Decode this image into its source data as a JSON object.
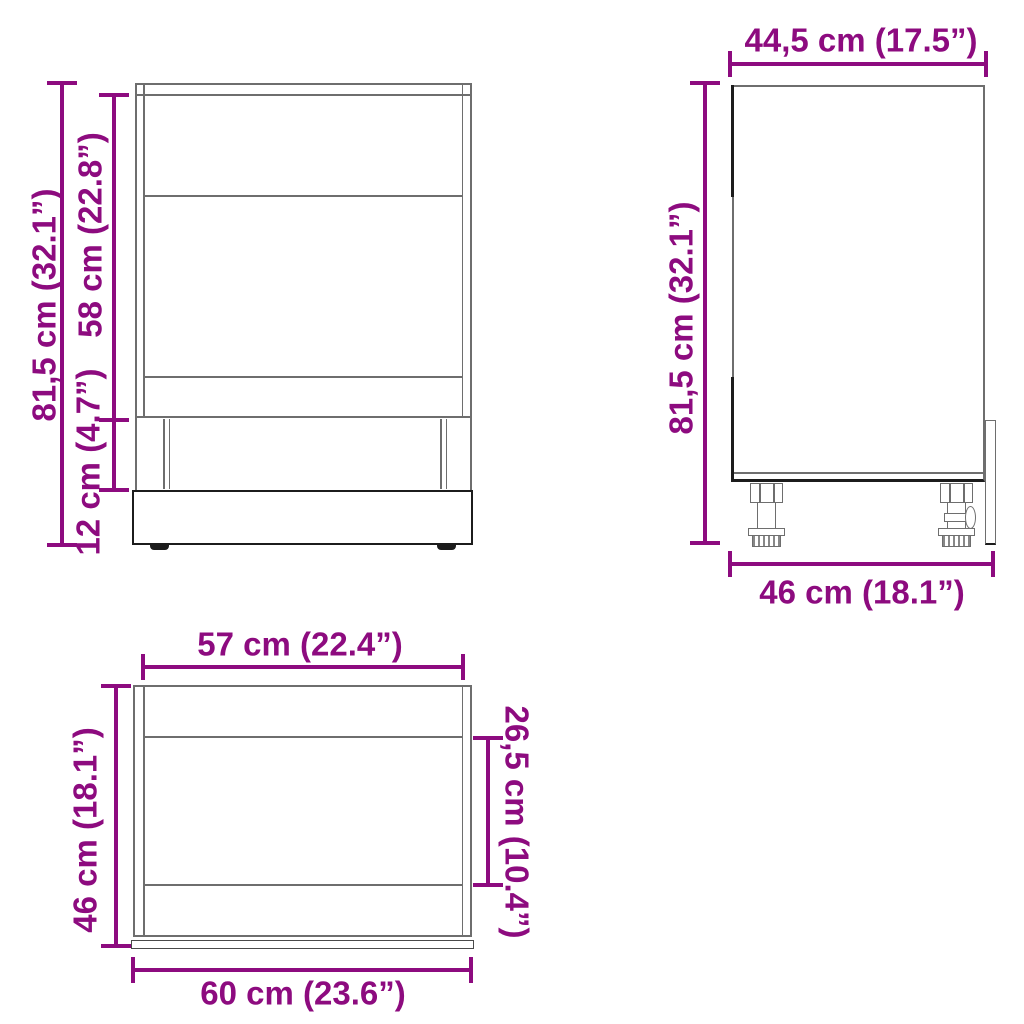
{
  "diagram": {
    "front_view": {
      "dim_total_height": "81,5 cm (32.1”)",
      "dim_door_height": "58 cm (22.8”)",
      "dim_plinth_height": "12 cm (4.7”)"
    },
    "side_view": {
      "dim_depth_top": "44,5 cm (17.5”)",
      "dim_total_height": "81,5 cm (32.1”)",
      "dim_depth_bottom": "46 cm (18.1”)"
    },
    "top_view": {
      "dim_carcass_width": "57 cm (22.4”)",
      "dim_depth": "46 cm (18.1”)",
      "dim_front_width": "60 cm (23.6”)",
      "dim_recess_depth": "26,5 cm (10.4”)"
    }
  },
  "colors": {
    "dimension_text": "#8d0b7f",
    "drawing_line": "#6e6e6e",
    "drawing_line_dark": "#1c1c1c",
    "background": "#ffffff"
  }
}
